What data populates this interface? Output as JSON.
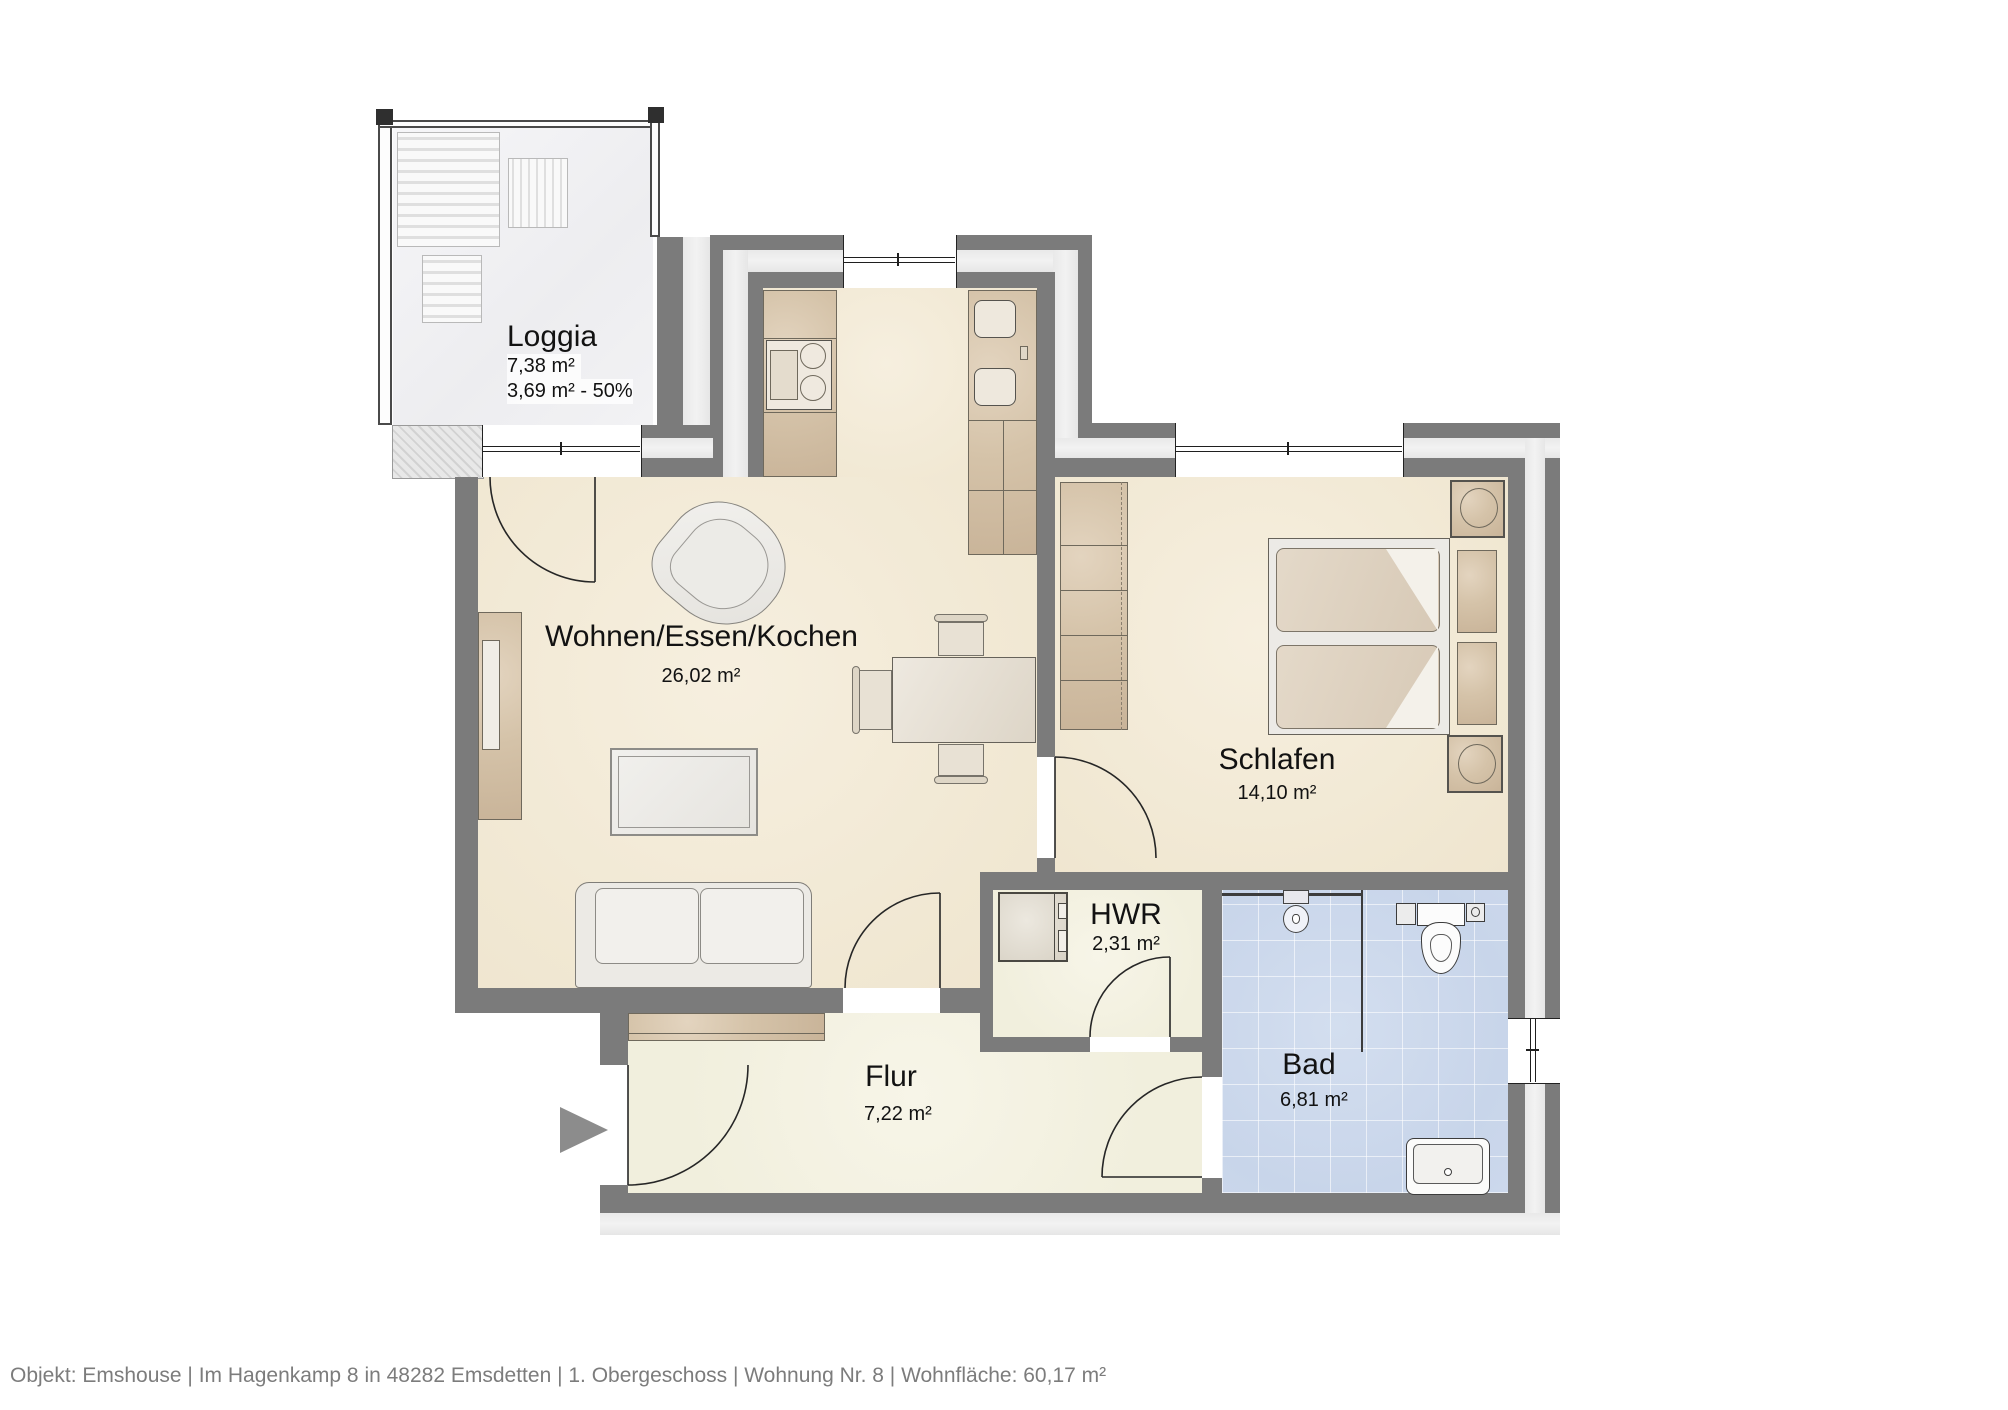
{
  "meta": {
    "footer": "Objekt: Emshouse | Im Hagenkamp 8 in 48282 Emsdetten | 1. Obergeschoss | Wohnung Nr. 8 | Wohnfläche: 60,17 m²"
  },
  "rooms": {
    "loggia": {
      "name": "Loggia",
      "area": "7,38 m²",
      "area2": "3,69 m² - 50%"
    },
    "living": {
      "name": "Wohnen/Essen/Kochen",
      "area": "26,02 m²"
    },
    "schlafen": {
      "name": "Schlafen",
      "area": "14,10 m²"
    },
    "hwr": {
      "name": "HWR",
      "area": "2,31 m²"
    },
    "bad": {
      "name": "Bad",
      "area": "6,81 m²"
    },
    "flur": {
      "name": "Flur",
      "area": "7,22 m²"
    }
  },
  "colors": {
    "wall": "#7b7b7b",
    "insulation": "#ebebeb",
    "floor_cream": "#f3ebd9",
    "floor_bath_tile": "#cdd9ec",
    "label_text": "#121212",
    "footer_text": "#7c7c7c",
    "entrance_arrow": "#8c8c8c"
  }
}
